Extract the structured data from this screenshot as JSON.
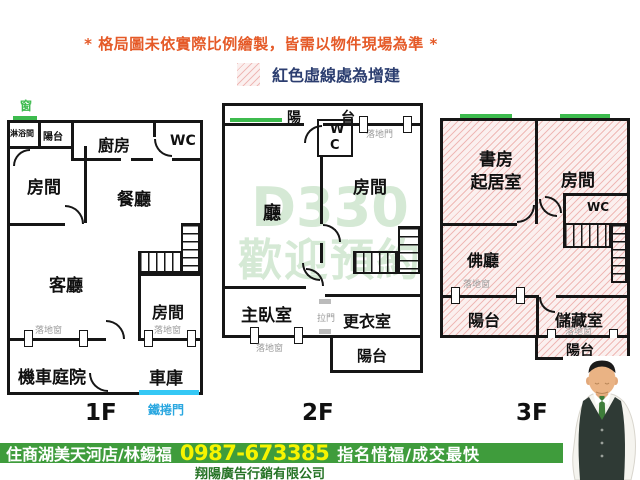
{
  "header": {
    "disclaimer": "* 格局圖未依實際比例繪製，皆需以物件現場為準 *",
    "legend_label": "紅色虛線處為增建"
  },
  "watermark": {
    "line1": "D330",
    "line2": "歡迎預約"
  },
  "plans": {
    "f1": {
      "floor_label": "1F",
      "rooms": {
        "shower": "淋浴間",
        "balcony": "陽台",
        "kitchen": "廚房",
        "wc": "WC",
        "room_left": "房間",
        "dining": "餐廳",
        "living": "客廳",
        "room_bottom": "房間",
        "yard": "機車庭院",
        "garage": "車庫"
      },
      "annotations": {
        "window_icon": "窗",
        "window_left": "落地窗",
        "window_right": "落地窗",
        "roller_door": "鐵捲門"
      }
    },
    "f2": {
      "floor_label": "2F",
      "rooms": {
        "balcony_top": "陽台",
        "wc_line1": "W",
        "wc_line2": "C",
        "hall": "廳",
        "room": "房間",
        "master": "主臥室",
        "closet": "更衣室",
        "balcony_bottom": "陽台"
      },
      "annotations": {
        "patio_door": "落地門",
        "sliding_door": "拉門",
        "window": "落地窗"
      }
    },
    "f3": {
      "floor_label": "3F",
      "rooms": {
        "study_line1": "書房",
        "study_line2": "起居室",
        "room": "房間",
        "wc": "WC",
        "buddha_hall": "佛廳",
        "balcony_left": "陽台",
        "storage": "儲藏室",
        "balcony_bottom": "陽台"
      },
      "annotations": {
        "window_left": "落地窗",
        "window_right": "落地窗"
      }
    }
  },
  "footer": {
    "agency": "住商湖美天河店/林錫福",
    "phone": "0987-673385",
    "slogan": "指名惜福/成交最快",
    "company": "翔陽廣告行銷有限公司"
  },
  "colors": {
    "disclaimer": "#e55a28",
    "legend_text": "#2c3e70",
    "addition_hatch": "#efb9b6",
    "window_green": "#3dbb4e",
    "roller_door_cyan": "#35c8f5",
    "footer_bar_green": "#3f9c3c",
    "phone_yellow": "#f7f400",
    "company_green": "#267326"
  }
}
